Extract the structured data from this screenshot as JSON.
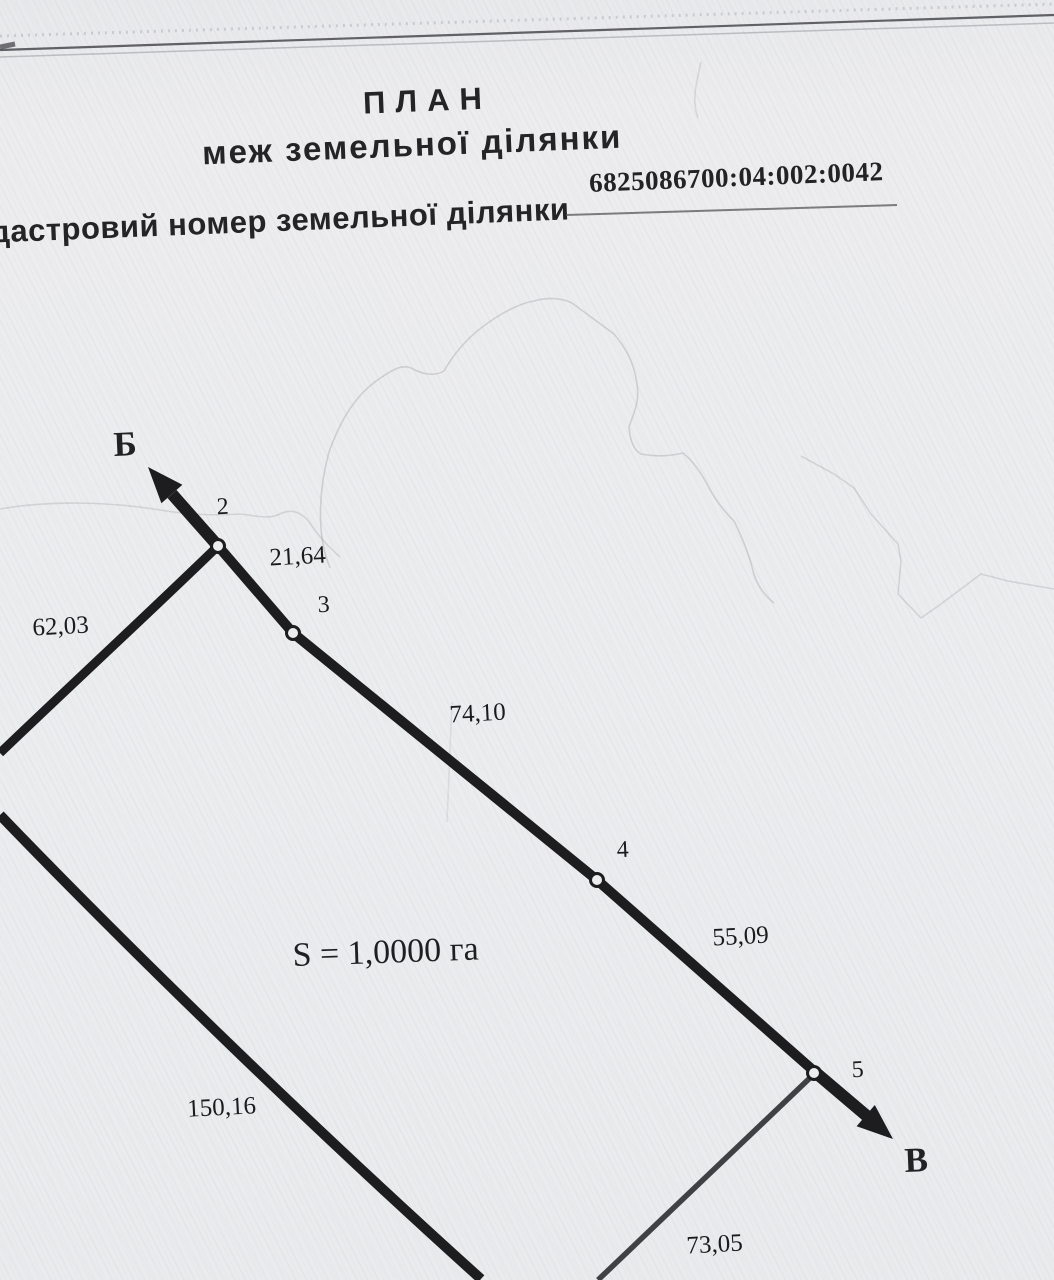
{
  "header": {
    "title_line1": "ПЛАН",
    "title_line2": "меж земельної ділянки",
    "cadastral_label": "дастровий номер земельної ділянки",
    "cadastral_number": "6825086700:04:002:0042"
  },
  "plan": {
    "area_label": "S = 1,0000 га",
    "markers": [
      "Б",
      "В"
    ],
    "point_labels": [
      "2",
      "3",
      "4",
      "5"
    ],
    "segment_labels": [
      "62,03",
      "21,64",
      "74,10",
      "55,09",
      "150,16",
      "73,05"
    ]
  },
  "colors": {
    "paper": "#ecedef",
    "ink": "#1d1d20",
    "pencil_trace": "#8a8a90"
  }
}
